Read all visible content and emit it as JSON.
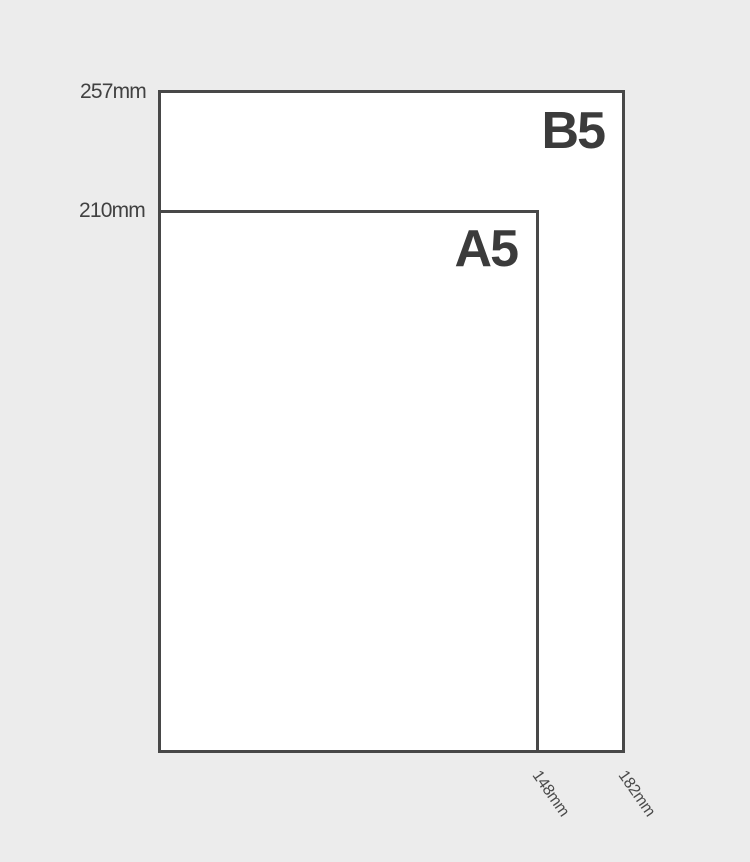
{
  "diagram": {
    "colors": {
      "background": "#ececec",
      "sheet_fill": "#ffffff",
      "outline": "#484848",
      "sheet_label_text": "#3b3b3b",
      "dimension_text": "#4a4a4a"
    },
    "sheets": [
      {
        "label": "B5",
        "height_label": "257mm",
        "width_label": "182mm"
      },
      {
        "label": "A5",
        "height_label": "210mm",
        "width_label": "148mm"
      }
    ]
  }
}
